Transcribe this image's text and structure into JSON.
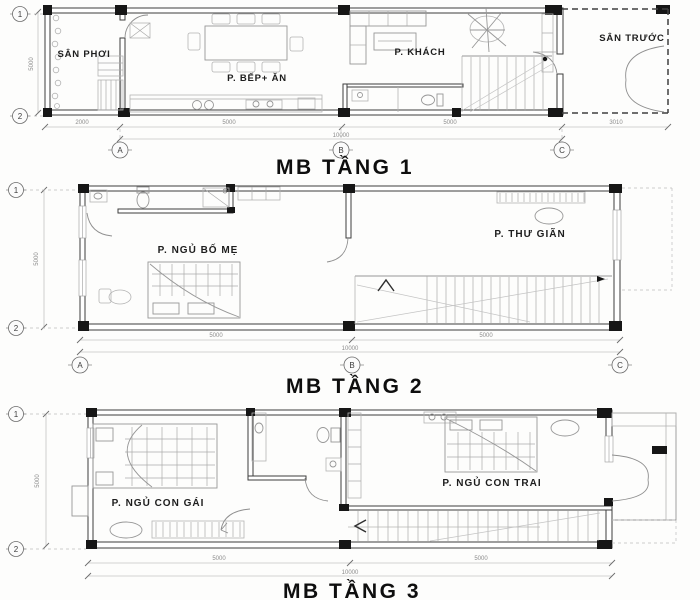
{
  "floor1": {
    "title": "MB TẦNG 1",
    "labels": {
      "utility_yard": "SÂN PHƠI",
      "kitchen_dining": "P. BẾP+ ĂN",
      "living_room": "P. KHÁCH",
      "front_yard": "SÂN TRƯỚC"
    },
    "grid": {
      "row1": "1",
      "row2": "2",
      "colA": "A",
      "colB": "B",
      "colC": "C"
    },
    "dimensions": {
      "height": "5000",
      "seg1": "2000",
      "seg2": "5000",
      "seg3": "5000",
      "seg4": "3010",
      "total": "10000"
    }
  },
  "floor2": {
    "title": "MB TẦNG 2",
    "labels": {
      "master_bedroom": "P. NGỦ BỐ MẸ",
      "relax_room": "P. THƯ GIÃN"
    },
    "grid": {
      "row1": "1",
      "row2": "2",
      "colA": "A",
      "colB": "B",
      "colC": "C"
    },
    "dimensions": {
      "height": "5000",
      "seg1": "5000",
      "seg2": "5000",
      "total": "10000"
    }
  },
  "floor3": {
    "title": "MB TẦNG 3",
    "labels": {
      "daughter_bedroom": "P. NGỦ CON GÁI",
      "son_bedroom": "P. NGỦ CON TRAI"
    },
    "grid": {
      "row1": "1",
      "row2": "2"
    },
    "dimensions": {
      "height": "5000",
      "seg1": "5000",
      "seg2": "5000",
      "total": "10000"
    }
  }
}
